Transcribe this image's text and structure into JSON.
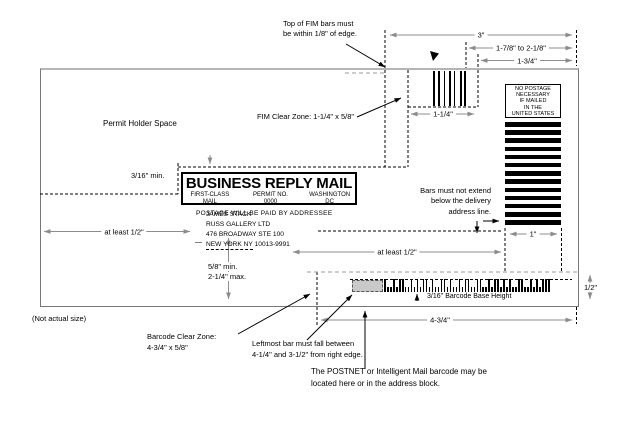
{
  "colors": {
    "dimension_line": "#8c8c8c",
    "bar_black": "#000000",
    "leftmost_bar_zone_shade": "#c9c9c9",
    "envelope_top_edge": "#b5b5b5"
  },
  "notes": {
    "fim_top_1": "Top of FIM bars must",
    "fim_top_2": "be within 1/8\" of edge.",
    "permit_holder": "Permit Holder Space",
    "fim_clear_zone": "FIM Clear Zone: 1-1/4\" x 5/8\"",
    "bars_1": "Bars must not extend",
    "bars_2": "below the delivery",
    "bars_3": "address line.",
    "not_actual_size": "(Not actual size)",
    "barcode_zone_1": "Barcode Clear Zone:",
    "barcode_zone_2": "4-3/4\" x 5/8\"",
    "leftmost_1": "Leftmost bar must fall between",
    "leftmost_2": "4-1/4\" and 3-1/2\" from right edge.",
    "postnet_1": "The POSTNET or Intelligent Mail barcode may be",
    "postnet_2": "located here or in the address block.",
    "base_height": "3/16'' Barcode Base Height"
  },
  "dims": {
    "three": "3\"",
    "range": "1-7/8\" to 2-1/8\"",
    "one_three_quarters": "1-3/4\"",
    "one_one_quarter": "1-1/4\"",
    "one_inch": "1\"",
    "half_inch": "1/2\"",
    "at_least_half_left": "at least 1/2\"",
    "at_least_half_mid": "at least 1/2\"",
    "three_sixteenths_min": "3/16\" min.",
    "five_eighths_min": "5/8\" min.",
    "two_one_quarter_max": "2-1/4\" max.",
    "four_three_quarters": "4-3/4\""
  },
  "brm": {
    "title": "BUSINESS REPLY MAIL",
    "class_line": "FIRST-CLASS MAIL",
    "permit_line": "PERMIT NO. 0000",
    "city_line": "WASHINGTON DC",
    "postage_line": "POSTAGE WILL BE PAID BY ADDRESSEE"
  },
  "no_postage": {
    "lines": [
      "NO POSTAGE",
      "NECESSARY",
      "IF MAILED",
      "IN THE",
      "UNITED STATES"
    ]
  },
  "address": {
    "line1": "JAMES STACK",
    "line2": "RUSS GALLERY LTD",
    "line3": "476 BROADWAY STE 100",
    "city": "NEW YORK NY",
    "zip": " 10013-9991"
  },
  "fim": {
    "bars": [
      [
        0,
        2
      ],
      [
        5,
        2
      ],
      [
        11,
        1
      ],
      [
        16,
        2
      ],
      [
        21,
        1
      ],
      [
        27,
        2
      ],
      [
        31,
        2
      ]
    ]
  },
  "right_bars": {
    "count": 13
  },
  "barcode": {
    "pattern": "TSSTSTTSSTSTSTTSTSSTTSTSSTSTTSSTTSSTSTTSTSTSSTTSSTSTSTTT"
  }
}
